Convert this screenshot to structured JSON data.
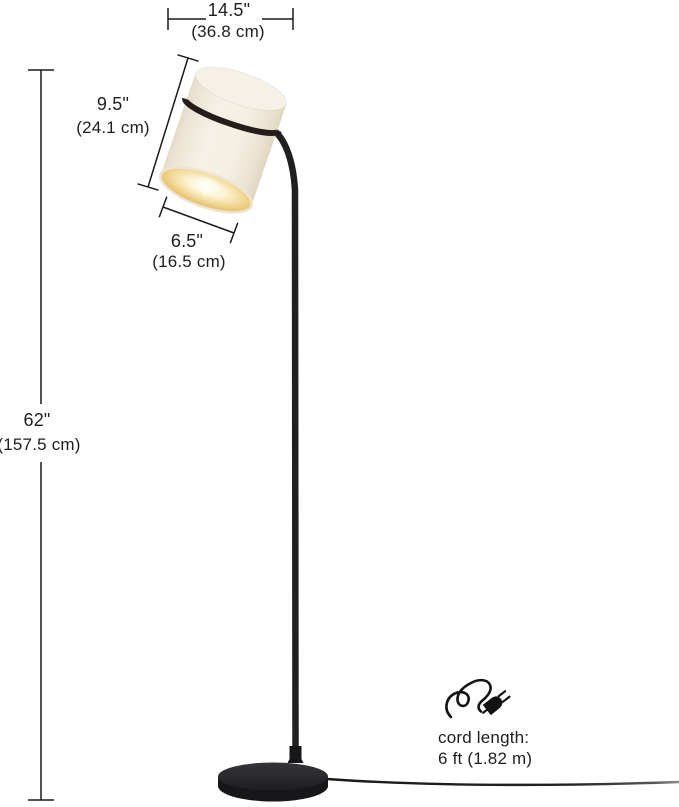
{
  "meta": {
    "description": "Product dimension diagram of a black floor lamp with tilted cream drum shade",
    "background_color": "#ffffff",
    "line_color": "#1c1c1c",
    "text_color": "#1e1e1e"
  },
  "annotations": {
    "shade_width": {
      "inches": "14.5\"",
      "metric": "(36.8 cm)"
    },
    "shade_height": {
      "inches": "9.5\"",
      "metric": "(24.1 cm)"
    },
    "shade_diameter": {
      "inches": "6.5\"",
      "metric": "(16.5 cm)"
    },
    "lamp_height": {
      "inches": "62\"",
      "metric": "(157.5 cm)"
    },
    "cord": {
      "label": "cord length:",
      "value": "6 ft (1.82 m)",
      "icon": "power-plug-cord-icon"
    }
  },
  "product": {
    "name": "floor lamp",
    "parts": [
      "tilted cylindrical fabric shade with black ring band",
      "curved black metal pole",
      "round black base",
      "power cord"
    ],
    "colors": {
      "shade_body": "#f3eee2",
      "shade_band": "#231e1b",
      "metal": "#1f1f21",
      "glow_center": "#fffefa",
      "glow_edge": "#d5a84f"
    }
  }
}
